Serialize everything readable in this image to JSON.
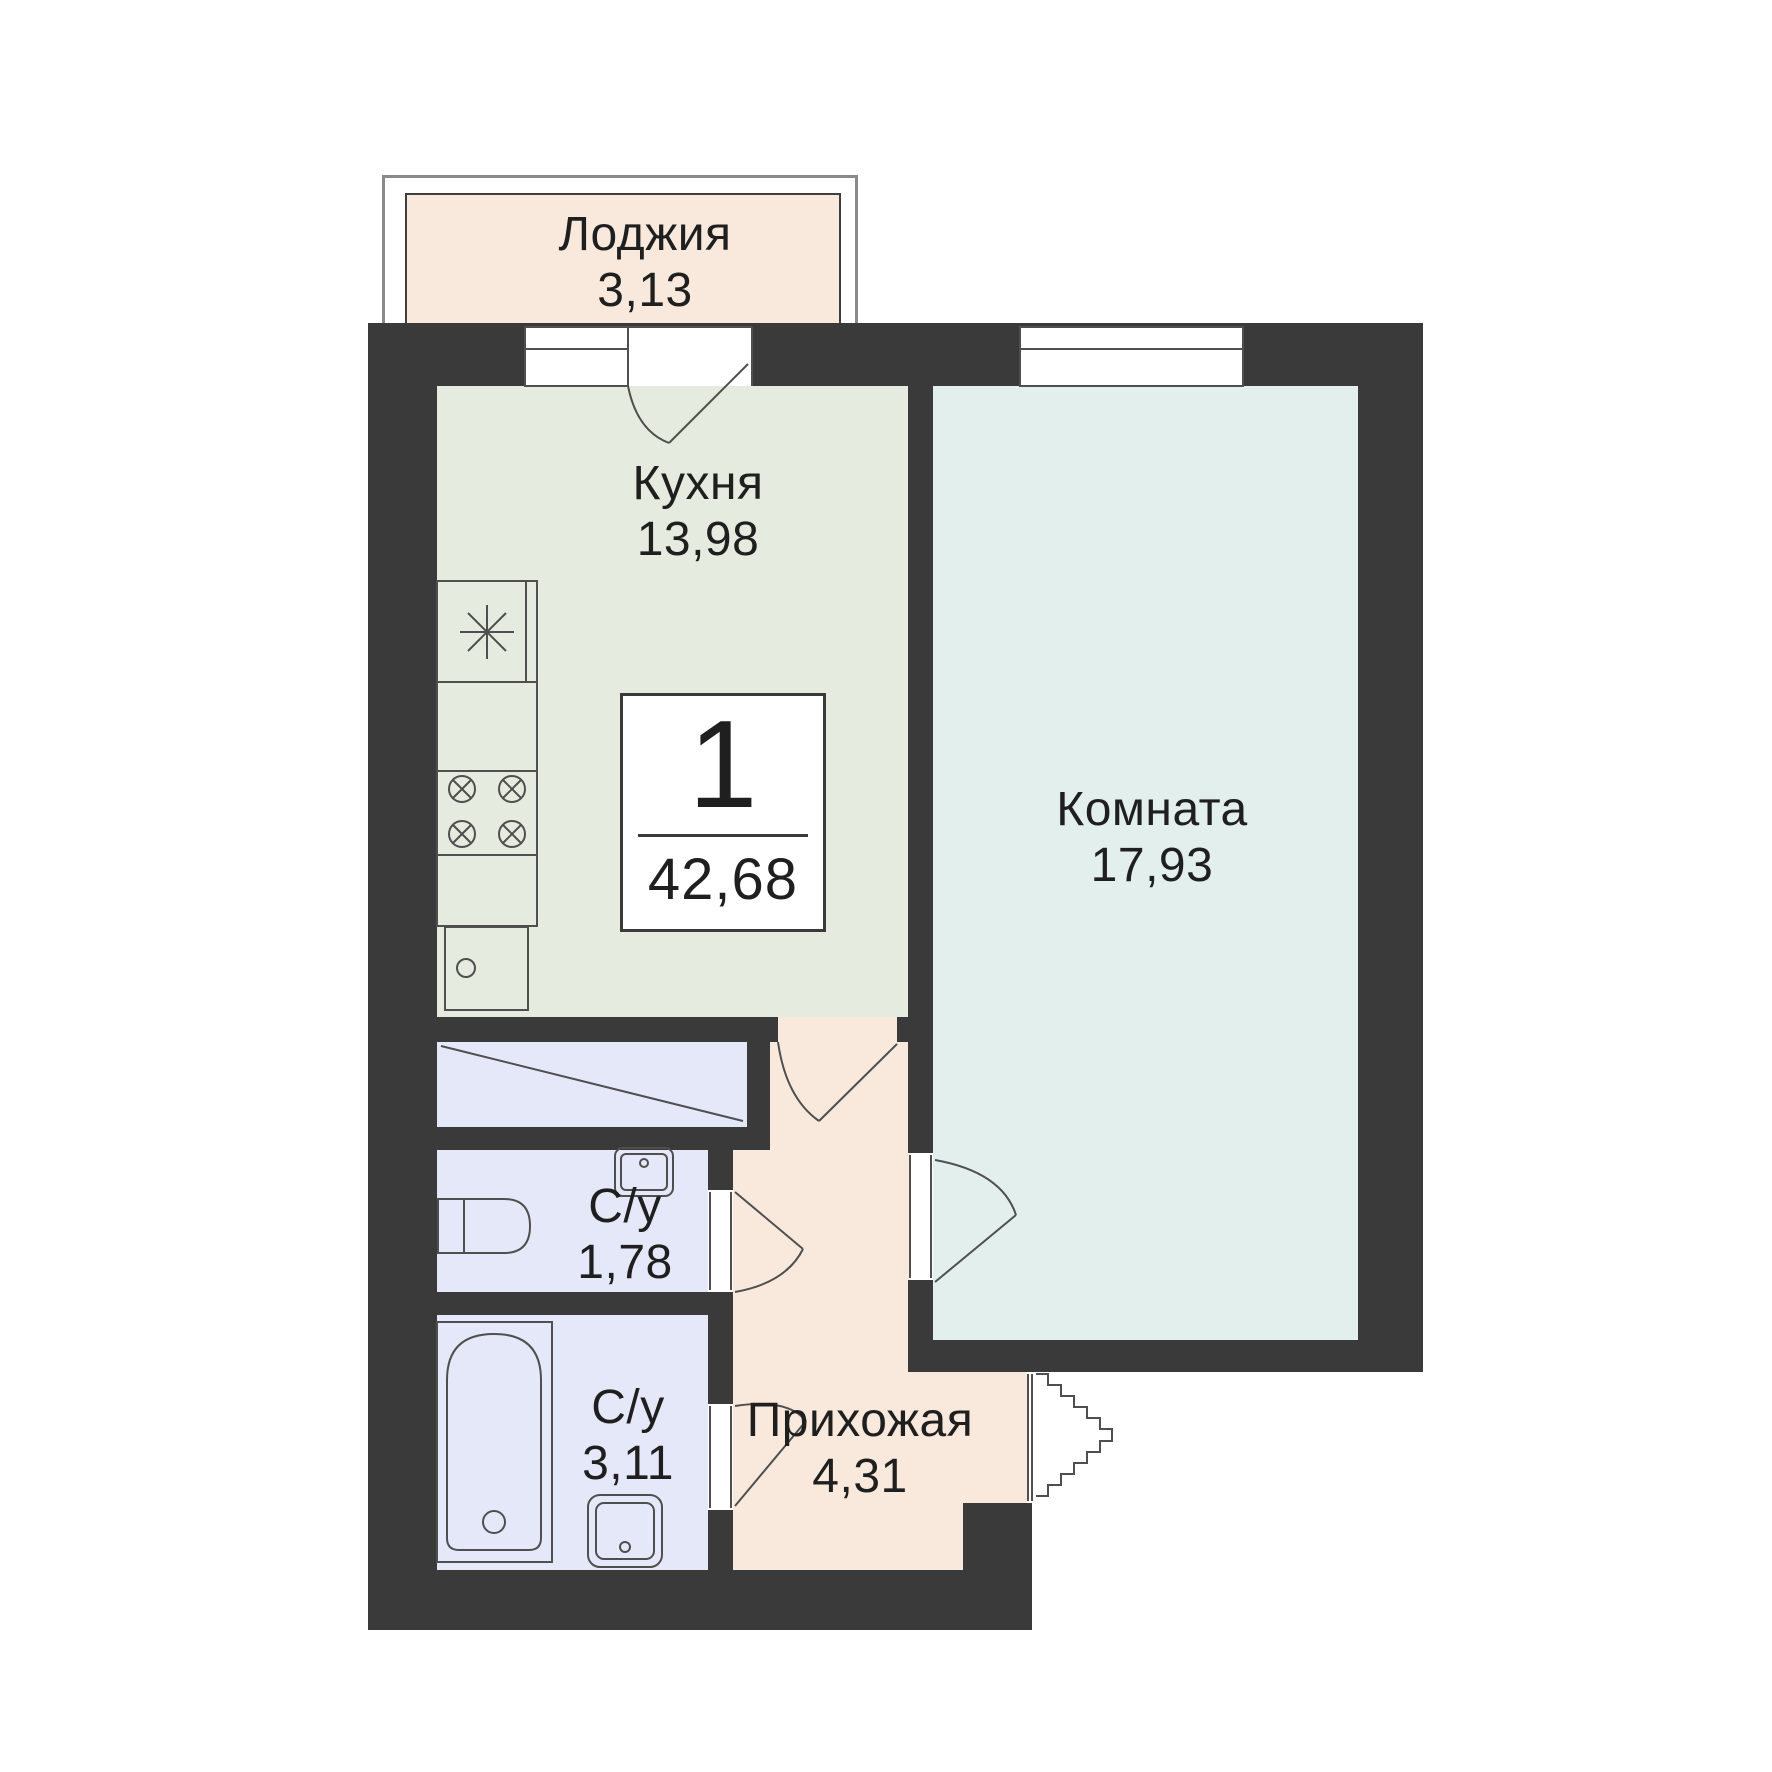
{
  "plan": {
    "title": "Floor plan of 1-room apartment",
    "badge": {
      "rooms": "1",
      "total_area": "42,68"
    },
    "rooms": {
      "loggia": {
        "name": "Лоджия",
        "area": "3,13"
      },
      "kitchen": {
        "name": "Кухня",
        "area": "13,98"
      },
      "living": {
        "name": "Комната",
        "area": "17,93"
      },
      "wc": {
        "name": "С/у",
        "area": "1,78"
      },
      "bathroom": {
        "name": "С/у",
        "area": "3,11"
      },
      "hallway": {
        "name": "Прихожая",
        "area": "4,31"
      }
    },
    "colors": {
      "wall": "#3a3a3a",
      "kitchen": "#e5ecdf",
      "room": "#e3efec",
      "wet": "#e4e8f8",
      "peach": "#f8e9dc",
      "line": "#4f4f4f",
      "text": "#1f1f1f"
    }
  }
}
